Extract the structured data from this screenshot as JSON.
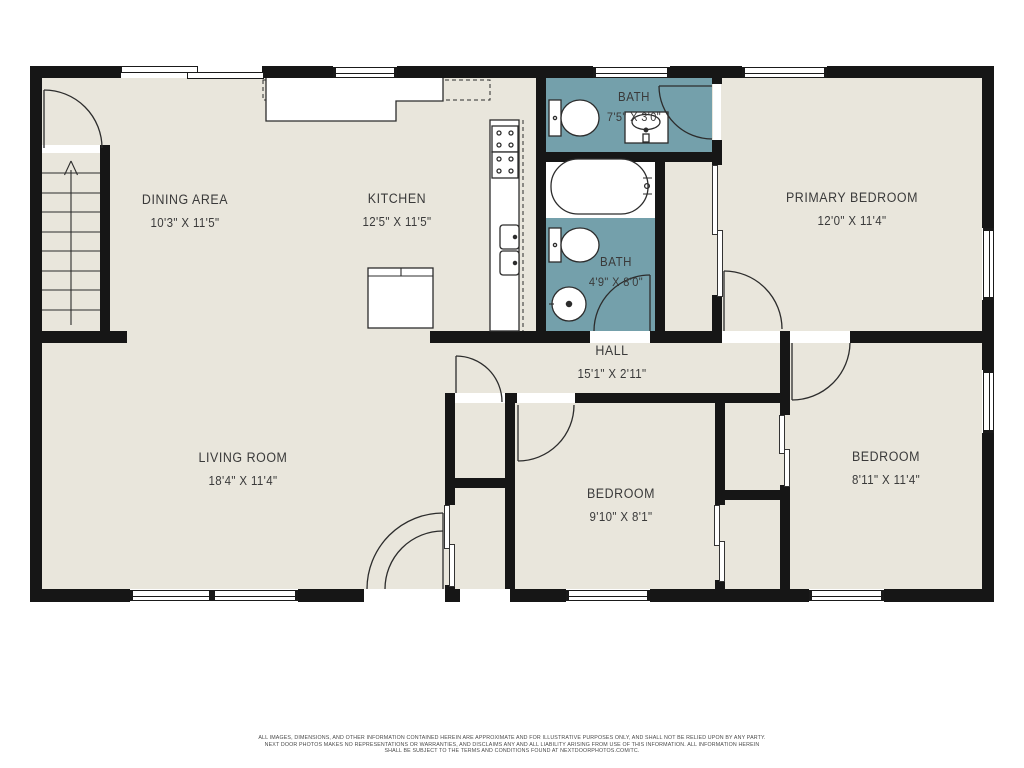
{
  "colors": {
    "wall": "#161616",
    "floor": "#e9e6dc",
    "bath": "#74a0ab",
    "text": "#3a3a3a"
  },
  "rooms": [
    {
      "id": "dining",
      "label": "DINING AREA",
      "dims": "10'3\" X 11'5\""
    },
    {
      "id": "kitchen",
      "label": "KITCHEN",
      "dims": "12'5\" X 11'5\""
    },
    {
      "id": "bath-top",
      "label": "BATH",
      "dims": "7'5\" X 3'0\""
    },
    {
      "id": "primary-bedroom",
      "label": "PRIMARY BEDROOM",
      "dims": "12'0\" X 11'4\""
    },
    {
      "id": "bath-bottom",
      "label": "BATH",
      "dims": "4'9\" X 8'0\""
    },
    {
      "id": "hall",
      "label": "HALL",
      "dims": "15'1\" X 2'11\""
    },
    {
      "id": "living-room",
      "label": "LIVING ROOM",
      "dims": "18'4\" X 11'4\""
    },
    {
      "id": "bedroom-middle",
      "label": "BEDROOM",
      "dims": "9'10\" X 8'1\""
    },
    {
      "id": "bedroom-right",
      "label": "BEDROOM",
      "dims": "8'11\" X 11'4\""
    }
  ],
  "disclaimer": {
    "line1": "ALL IMAGES, DIMENSIONS, AND OTHER INFORMATION CONTAINED HEREIN ARE APPROXIMATE AND FOR ILLUSTRATIVE PURPOSES ONLY, AND SHALL NOT BE RELIED UPON BY ANY PARTY.",
    "line2": "NEXT DOOR PHOTOS MAKES NO REPRESENTATIONS OR WARRANTIES, AND DISCLAIMS ANY AND ALL LIABILITY ARISING FROM USE OF THIS INFORMATION. ALL INFORMATION HEREIN",
    "line3": "SHALL BE SUBJECT TO THE TERMS AND CONDITIONS FOUND AT NEXTDOORPHOTOS.COM/TC."
  }
}
